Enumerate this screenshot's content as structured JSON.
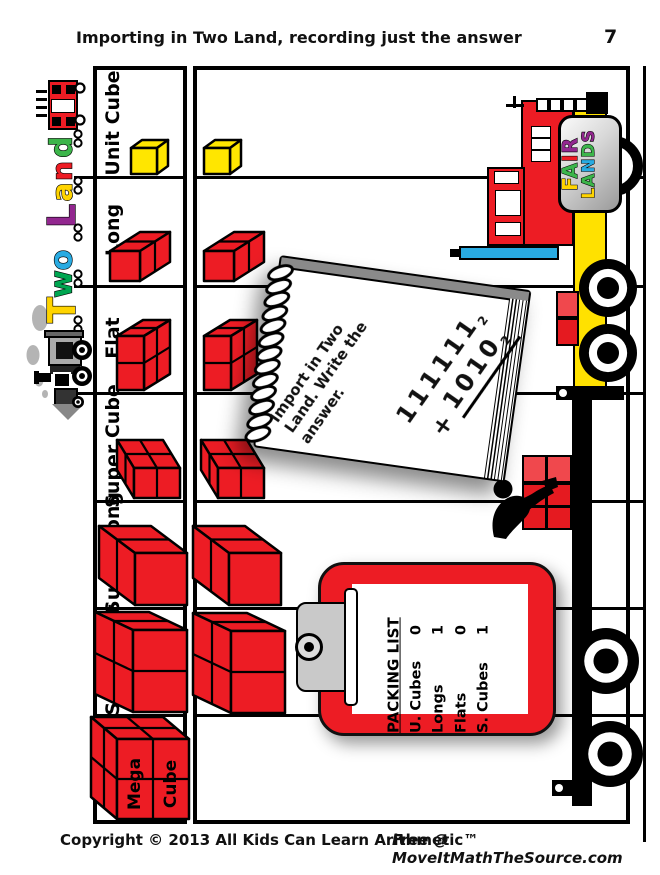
{
  "header": {
    "title": "Importing in Two Land, recording just the answer",
    "page_number": "7"
  },
  "footer": {
    "copyright": "Copyright © 2013 All Kids Can Learn Arithmetic™",
    "source": "Free @ MoveItMathTheSource.com"
  },
  "train": {
    "word": "Two Land",
    "letters": [
      {
        "ch": "d",
        "color": "#3CB54A"
      },
      {
        "ch": "n",
        "color": "#ED1C24"
      },
      {
        "ch": "a",
        "color": "#FFD400"
      },
      {
        "ch": "L",
        "color": "#92278F"
      },
      {
        "ch": "o",
        "color": "#29ABE2"
      },
      {
        "ch": "w",
        "color": "#00A651"
      },
      {
        "ch": "T",
        "color": "#FFD400"
      }
    ]
  },
  "rows": [
    {
      "label": "Unit Cube",
      "block": "unit-cube",
      "block_color": "#FFE600"
    },
    {
      "label": "Long",
      "block": "long",
      "block_color": "#ED1C24"
    },
    {
      "label": "Flat",
      "block": "flat",
      "block_color": "#ED1C24"
    },
    {
      "label": "Super Cube",
      "block": "super-cube",
      "block_color": "#ED1C24"
    },
    {
      "label": "Super Long",
      "block": "super-long",
      "block_color": "#ED1C24"
    },
    {
      "label": "Super Flat",
      "block": "super-flat",
      "block_color": "#ED1C24"
    },
    {
      "label": "Mega Cube",
      "block": "mega-cube",
      "block_color": "#ED1C24",
      "block_text": [
        "Mega",
        "Cube"
      ]
    }
  ],
  "notebook": {
    "instruction_lines": [
      "Import in Two",
      "Land. Write the",
      "answer."
    ],
    "problem": {
      "top": "111111",
      "top_base": "2",
      "op": "+",
      "bottom": "1010",
      "bottom_base": "2"
    }
  },
  "clipboard": {
    "title": "PACKING LIST",
    "items": [
      {
        "name": "U. Cubes",
        "qty": "0"
      },
      {
        "name": "Longs",
        "qty": "1"
      },
      {
        "name": "Flats",
        "qty": "0"
      },
      {
        "name": "S. Cubes",
        "qty": "1"
      }
    ]
  },
  "truck_sign": {
    "words": [
      {
        "word": "FAIR",
        "colors": [
          "#FFD400",
          "#3CB54A",
          "#ED1C24",
          "#92278F"
        ]
      },
      {
        "word": "LANDS",
        "colors": [
          "#FFD400",
          "#3CB54A",
          "#29ABE2",
          "#3CB54A",
          "#92278F"
        ]
      }
    ]
  },
  "colors": {
    "block_red": "#ED1C24",
    "block_red_light": "#F0484D",
    "unit_yellow": "#FFE600",
    "truck_yellow": "#FFE100",
    "truck_blue": "#29ABE2",
    "smoke_gray": "#B4B4B4"
  }
}
